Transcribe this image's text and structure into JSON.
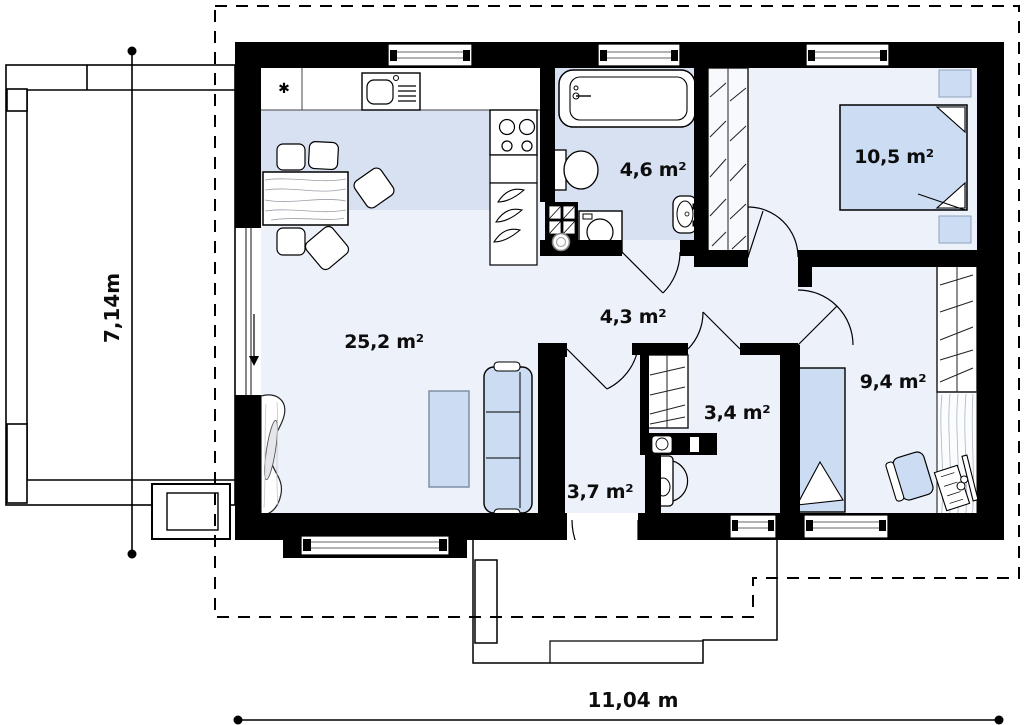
{
  "plan": {
    "type": "house floor plan",
    "rooms": [
      {
        "id": "living-room-kitchen",
        "area_label": "25,2 m²"
      },
      {
        "id": "bathroom",
        "area_label": "4,6 m²"
      },
      {
        "id": "bedroom-main",
        "area_label": "10,5 m²"
      },
      {
        "id": "hallway",
        "area_label": "4,3 m²"
      },
      {
        "id": "wc",
        "area_label": "3,4 m²"
      },
      {
        "id": "entrance-hall",
        "area_label": "3,7 m²"
      },
      {
        "id": "bedroom-second",
        "area_label": "9,4 m²"
      }
    ],
    "dimensions": {
      "width_label": "11,04 m",
      "height_label": "7,14m"
    },
    "kitchen_symbol": "✱",
    "colors": {
      "wall": "#000000",
      "floor_light": "#edf1f9",
      "floor_shaded": "#d7e1f1",
      "furniture_fill": "#ccdcf2",
      "closet_fill": "#f7f9fc",
      "line": "#111111",
      "grain": "#9aa0a8"
    }
  }
}
